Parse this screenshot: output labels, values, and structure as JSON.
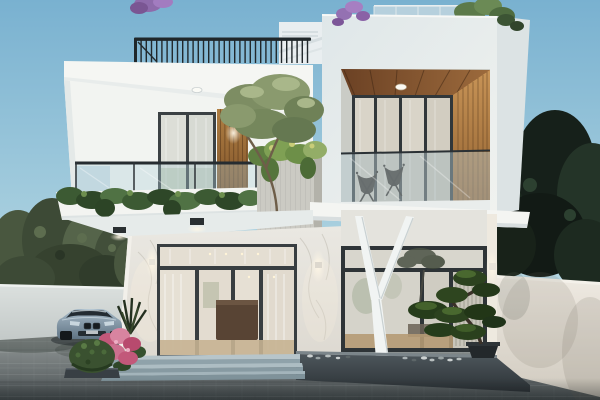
{
  "meta": {
    "scene_title": "Modern two-storey white villa - dusk exterior architectural render",
    "image_type": "3D architectural visualization, no visible text"
  },
  "palette": {
    "sky_top": "#79b1d0",
    "sky_mid": "#a6cede",
    "sky_bottom": "#d2e6ec",
    "house_white": "#f2f4f1",
    "tower_white_top": "#dfe7e9",
    "tower_white_bottom": "#f0f2ef",
    "left_wall": "#dbe0de",
    "right_wall": "#efeae2",
    "marble_top": "#eae8e2",
    "marble_bottom": "#ddd9d1",
    "frame_black": "#383e41",
    "railing_black": "#20272a",
    "wood_ceiling_dark": "#6b4124",
    "wood_ceiling_light": "#9c6a3c",
    "wood_wall": "#c89457",
    "wood_strip": "#a4763f",
    "pavement_light": "#a9acaa",
    "pavement_dark": "#4b5254",
    "step_tread": "#b7c5ca",
    "planter_stone": "#4d565c",
    "y_column": "#f1f4f3",
    "foliage_left": "#49573f",
    "foliage_right": "#1d2a20",
    "ivy_green": "#3c5a33",
    "olive_canopy": "#7d8d63",
    "bonsai_green": "#2c421f",
    "bush_green": "#3a5130",
    "flower_pink": "#c2587a",
    "flower_purple": "#9673b4",
    "car_body_light": "#a7bac8",
    "car_body_dark": "#5f7383",
    "sconce_glow": "#fff7e6"
  },
  "scene": {
    "objects": [
      "sky",
      "purple-blossom-trees",
      "rooftop-railing",
      "rooftop-stair-bulkhead",
      "rooftop-glass-parapet",
      "rooftop-tree",
      "left-background-trees",
      "right-background-trees",
      "left-boundary-wall",
      "right-boundary-wall",
      "paved-driveway",
      "roof-slab",
      "second-floor-balcony",
      "balcony-glass-balustrade",
      "balcony-glass-door",
      "wood-accent-panel",
      "trailing-ivy",
      "concrete-planter",
      "olive-tree",
      "recessed-loggia",
      "loggia-wood-ceiling",
      "loggia-glass-doors",
      "loggia-chairs",
      "loggia-wood-wall",
      "floor-slab",
      "marble-entrance-wall",
      "entrance-glass-doors",
      "wall-sconces",
      "feature-window",
      "y-shaped-column",
      "stone-planter-bed",
      "pebbles",
      "bonsai-pine",
      "entrance-steps",
      "parked-coupe",
      "pink-flower-shrub",
      "round-bush",
      "agave-plant",
      "ceiling-downlights"
    ]
  }
}
